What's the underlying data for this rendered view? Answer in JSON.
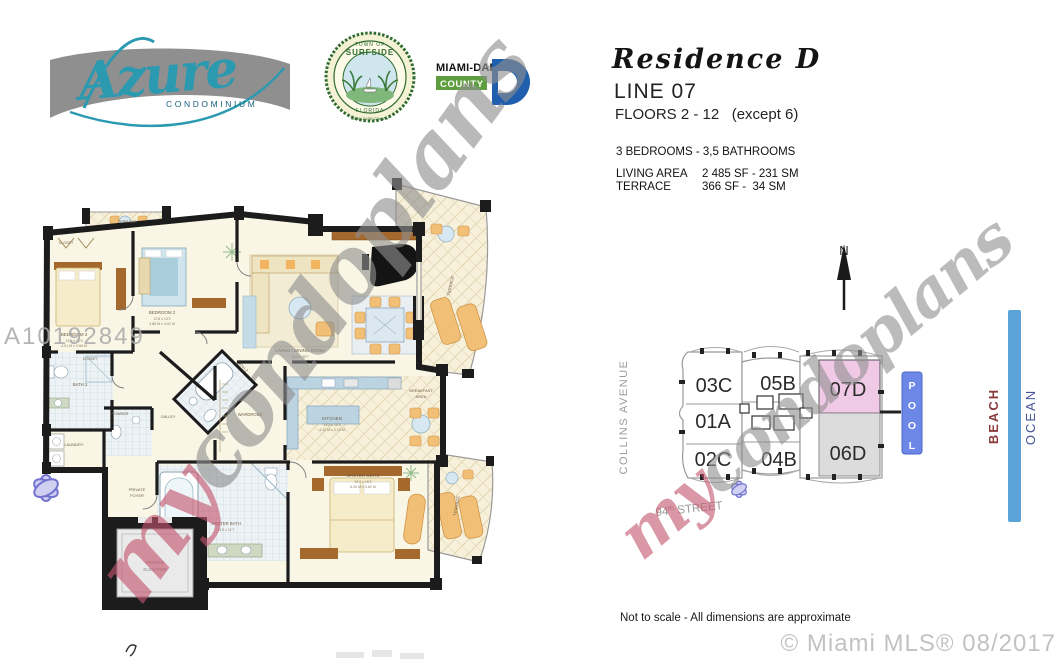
{
  "header": {
    "azure": {
      "name": "Azure",
      "tagline": "CONDOMINIUM"
    },
    "seal": {
      "top": "TOWN OF",
      "name": "SURFSIDE",
      "state": "FLORIDA",
      "bottom": "MIAMI-DADE COUNTY"
    },
    "county_logo": {
      "line1": "MIAMI-DADE",
      "line2": "COUNTY"
    },
    "residence": "Residence D",
    "line": "LINE 07",
    "floors": "FLOORS 2 - 12   (except 6)",
    "config": "3 BEDROOMS - 3,5 BATHROOMS",
    "area_rows": [
      {
        "label": "LIVING AREA",
        "value": "2 485 SF - 231 SM"
      },
      {
        "label": "TERRACE",
        "value": "366 SF -  34 SM"
      }
    ]
  },
  "floor_plan": {
    "mls_number": "A10192849",
    "watermark": {
      "prefix": "my",
      "suffix": "condoplans"
    },
    "rooms": {
      "terrace_top": "TERRACE",
      "closet_top": "CLOSET",
      "closet_hall": "CLOSET",
      "bedroom3": {
        "name": "BEDROOM 3",
        "ft": "13'2 x 13'0",
        "m": "4.01 M x 3.96 M"
      },
      "bedroom2": {
        "name": "BEDROOM 2",
        "ft": "12'8 x 13'2",
        "m": "3.86 M x 4.01 M"
      },
      "bath2": "BATH 2",
      "bath3": "BATH 3",
      "powder": "POWDER",
      "laundry": "LAUNDRY",
      "galley": "GALLEY",
      "wardrobe": "WARDROBE",
      "kitchen": {
        "name": "KITCHEN",
        "ft": "14'2 x 10'2",
        "m": "4.32 M x 3.10 M"
      },
      "breakfast_1": "BREAKFAST",
      "breakfast_2": "AREA",
      "living": {
        "name": "LIVING / DINING ROOM",
        "ft": "14'2 x 30'7",
        "m": "4.32 M x 9.32 M"
      },
      "master": {
        "name": "MASTER SUITE",
        "ft": "20'4 x 15'2",
        "m": "6.20 M x 4.62 M"
      },
      "master_bath": {
        "name": "MASTER BATH",
        "ft": "11'0 x 11'7",
        "m": "3.35 M x 3.53 M"
      },
      "foyer_1": "PRIVATE",
      "foyer_2": "FOYER",
      "elevator_1": "PRIVATE",
      "elevator_2": "ELEVATOR",
      "terrace_right": "TERRACE",
      "terrace_bottom": "TERRACE"
    }
  },
  "site_plan": {
    "north": "N",
    "street_left": "COLLINS AVENUE",
    "street_bottom_num": "94",
    "street_bottom_sup": "th",
    "street_bottom_name": " STREET",
    "units": {
      "u03c": "03C",
      "u05b": "05B",
      "u07d": "07D",
      "u01a": "01A",
      "u02c": "02C",
      "u04b": "04B",
      "u06d": "06D"
    },
    "pool_letters": [
      "P",
      "O",
      "O",
      "L"
    ],
    "beach": "BEACH",
    "ocean": "OCEAN",
    "watermark": {
      "prefix": "my",
      "suffix": "condoplans"
    },
    "colors": {
      "unit_highlight": "#f0c9e6",
      "unit_shaded": "#dcdcdc",
      "pool": "#6d87e6",
      "ocean_bar": "#5aa2d8"
    }
  },
  "footer": {
    "note": "Not to scale - All dimensions are approximate",
    "copyright": "© Miami MLS® 08/2017"
  }
}
